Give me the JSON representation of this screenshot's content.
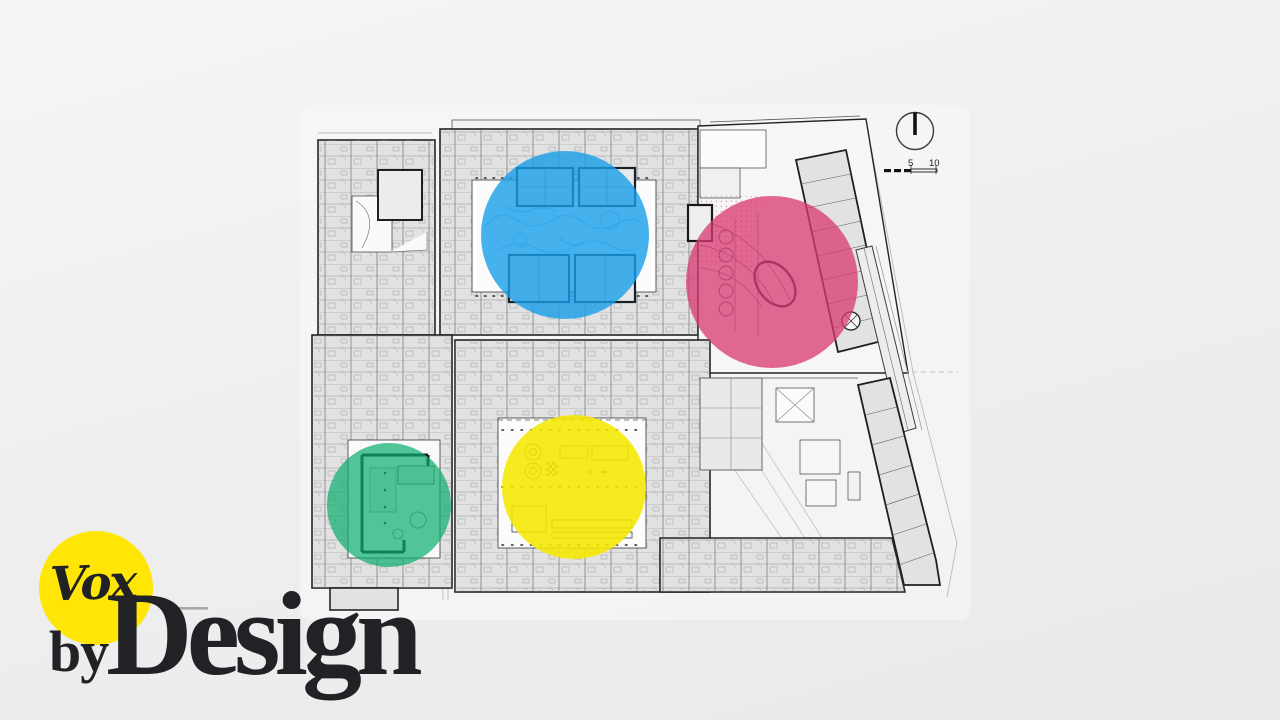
{
  "brand": {
    "logo_text": "Vox",
    "byline": "by",
    "series_title": "Design",
    "logo_color": "#ffe607",
    "text_color": "#212226"
  },
  "plan": {
    "scale_bar": {
      "label_mid": "5",
      "label_end": "10"
    },
    "highlights": {
      "blue": "#189fe8",
      "pink": "#d93a72",
      "green": "#0faf72",
      "yellow": "#f5e800"
    }
  }
}
